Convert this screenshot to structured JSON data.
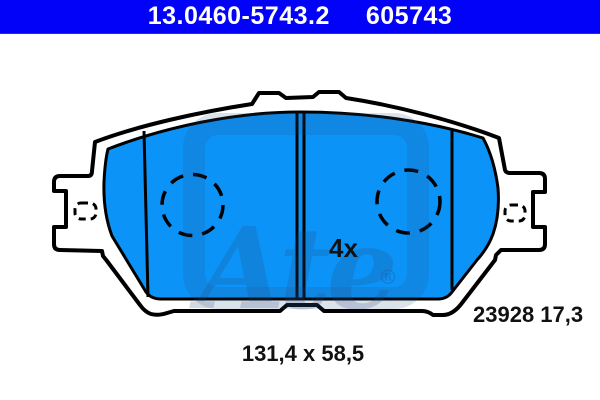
{
  "header": {
    "part_number": "13.0460-5743.2",
    "part_code": "605743"
  },
  "drawing": {
    "quantity_label": "4x",
    "pad_ref_label": "23928 17,3",
    "dimensions_label": "131,4 x 58,5",
    "watermark_text": "Ate",
    "watermark_registered": "®"
  },
  "colors": {
    "header_bg": "#0202f8",
    "header_text": "#ffffff",
    "pad_fill": "#0c93f7",
    "outline": "#000000",
    "watermark": "#24487a"
  }
}
